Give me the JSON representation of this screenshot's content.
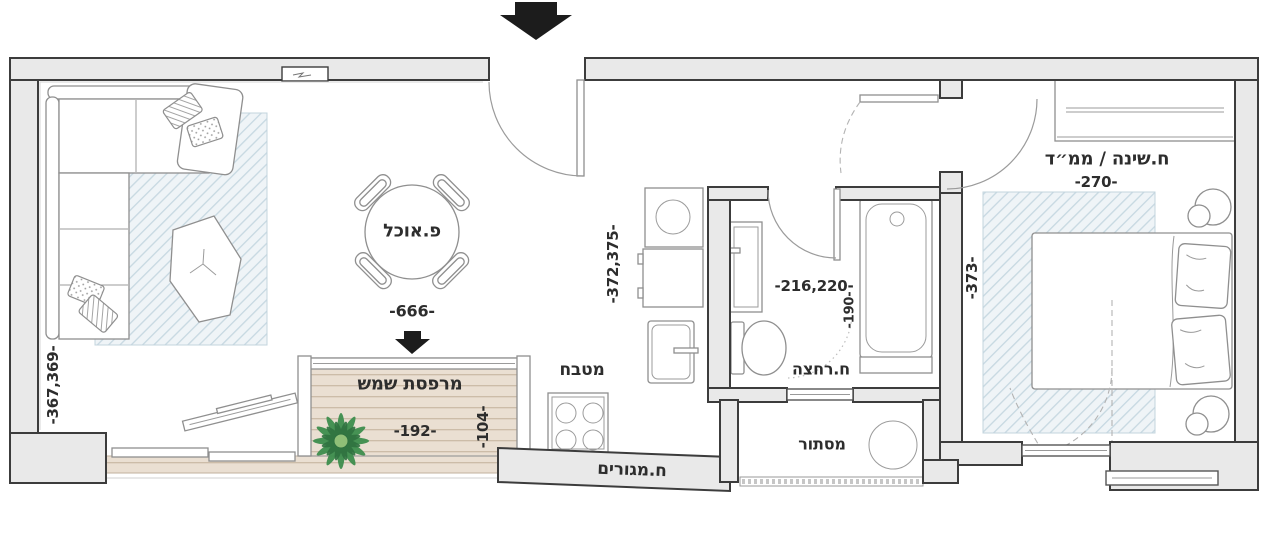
{
  "meta": {
    "type": "apartment-floor-plan",
    "language": "hebrew"
  },
  "colors": {
    "wall_fill": "#e9e9e9",
    "wall_stroke": "#3c3c3c",
    "rug_hatch": "#c6d8e1",
    "deck_fill": "#eadfd2",
    "deck_line": "#c9b8a4",
    "plant_green": "#3e8e4e",
    "arrow_black": "#1c1c1c",
    "text": "#2d2d2d"
  },
  "rooms": {
    "dining": {
      "label": "פ.אוכל",
      "dim_width": "-666-"
    },
    "balcony": {
      "label": "מרפסת שמש",
      "dim_width": "-192-",
      "dim_depth": "-104-"
    },
    "kitchen": {
      "label": "מטבח",
      "dim": "-372,375-"
    },
    "bathroom": {
      "label": "ח.רחצה",
      "dim": "-216,220-",
      "dim_door": "-190-"
    },
    "bedroom": {
      "label": "ח.שינה / ממ״ד",
      "dim_width": "-270-",
      "dim_depth": "-373-"
    },
    "living": {
      "label": "ח.מגורים",
      "dim_depth": "-367,369-"
    },
    "service": {
      "label": "מסתור"
    }
  }
}
